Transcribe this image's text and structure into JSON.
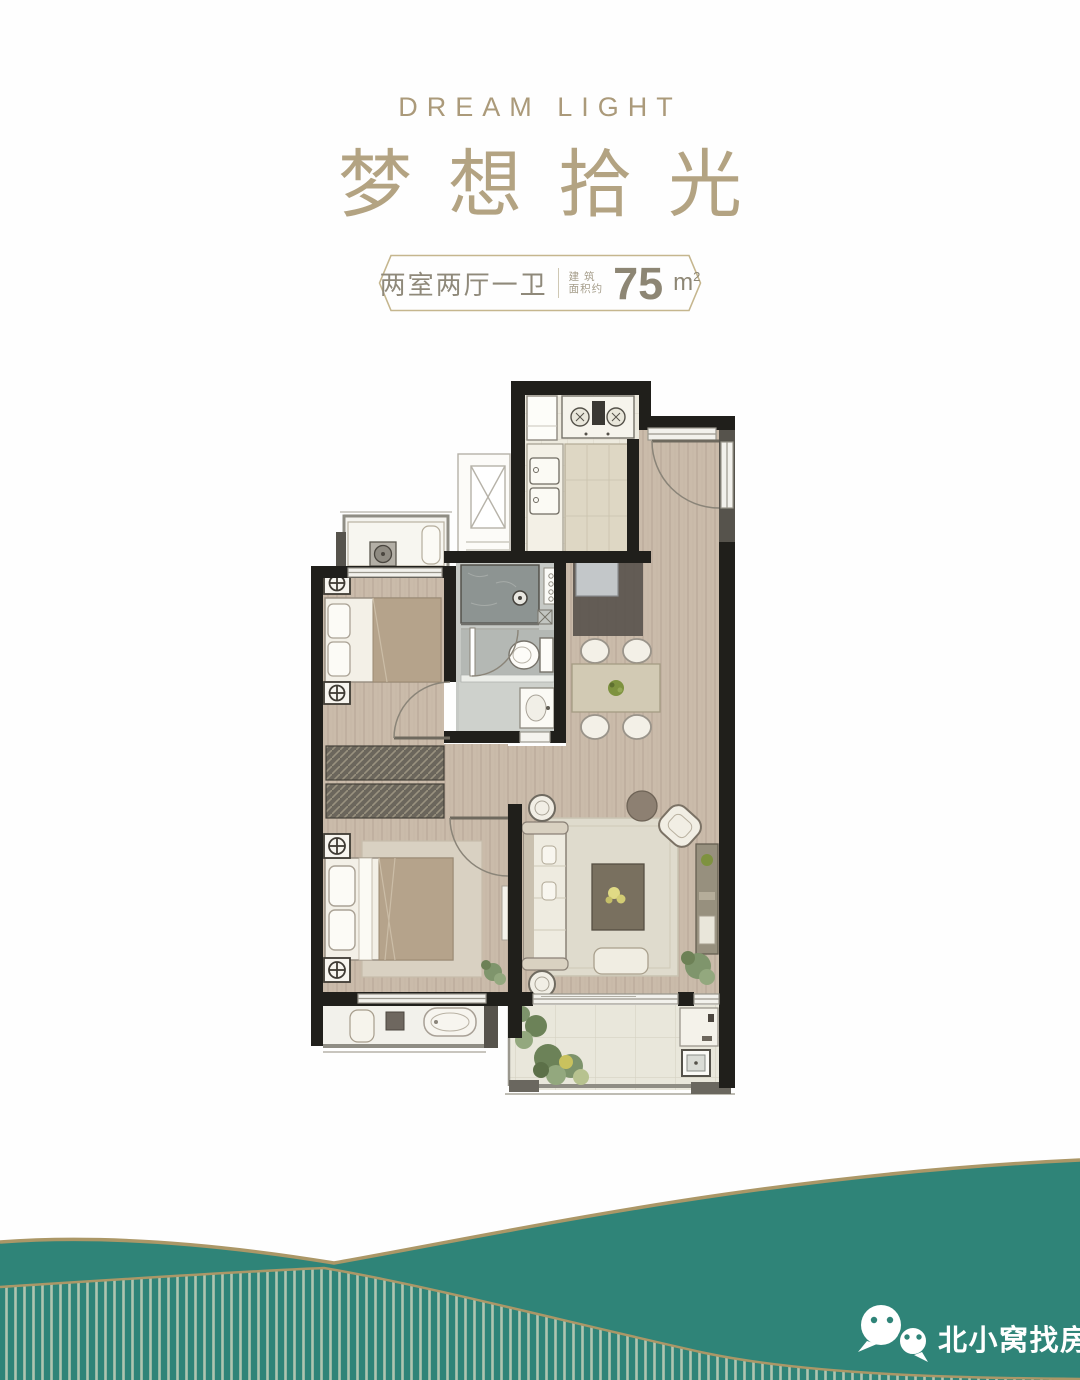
{
  "header": {
    "subtitle_en": "DREAM LIGHT",
    "title_cn": "梦想拾光",
    "badge": {
      "layout_label": "两室两厅一卫",
      "area_label_line1": "建 筑",
      "area_label_line2": "面积约",
      "area_value": "75",
      "area_unit": "m",
      "area_unit_sup": "2"
    }
  },
  "footer": {
    "brand_name": "北小窝找房",
    "wechat_icon": "wechat-logo"
  },
  "colors": {
    "teal": "#2f8478",
    "gold_line": "#ab9767",
    "stripe_line": "#c6d0ba",
    "gold_text": "#ab9a7a",
    "gold_title": "#b3a382",
    "badge_text": "#8f897a",
    "badge_border": "#c5b68e",
    "wall": "#201f1b",
    "wood": "#cabbaa"
  }
}
